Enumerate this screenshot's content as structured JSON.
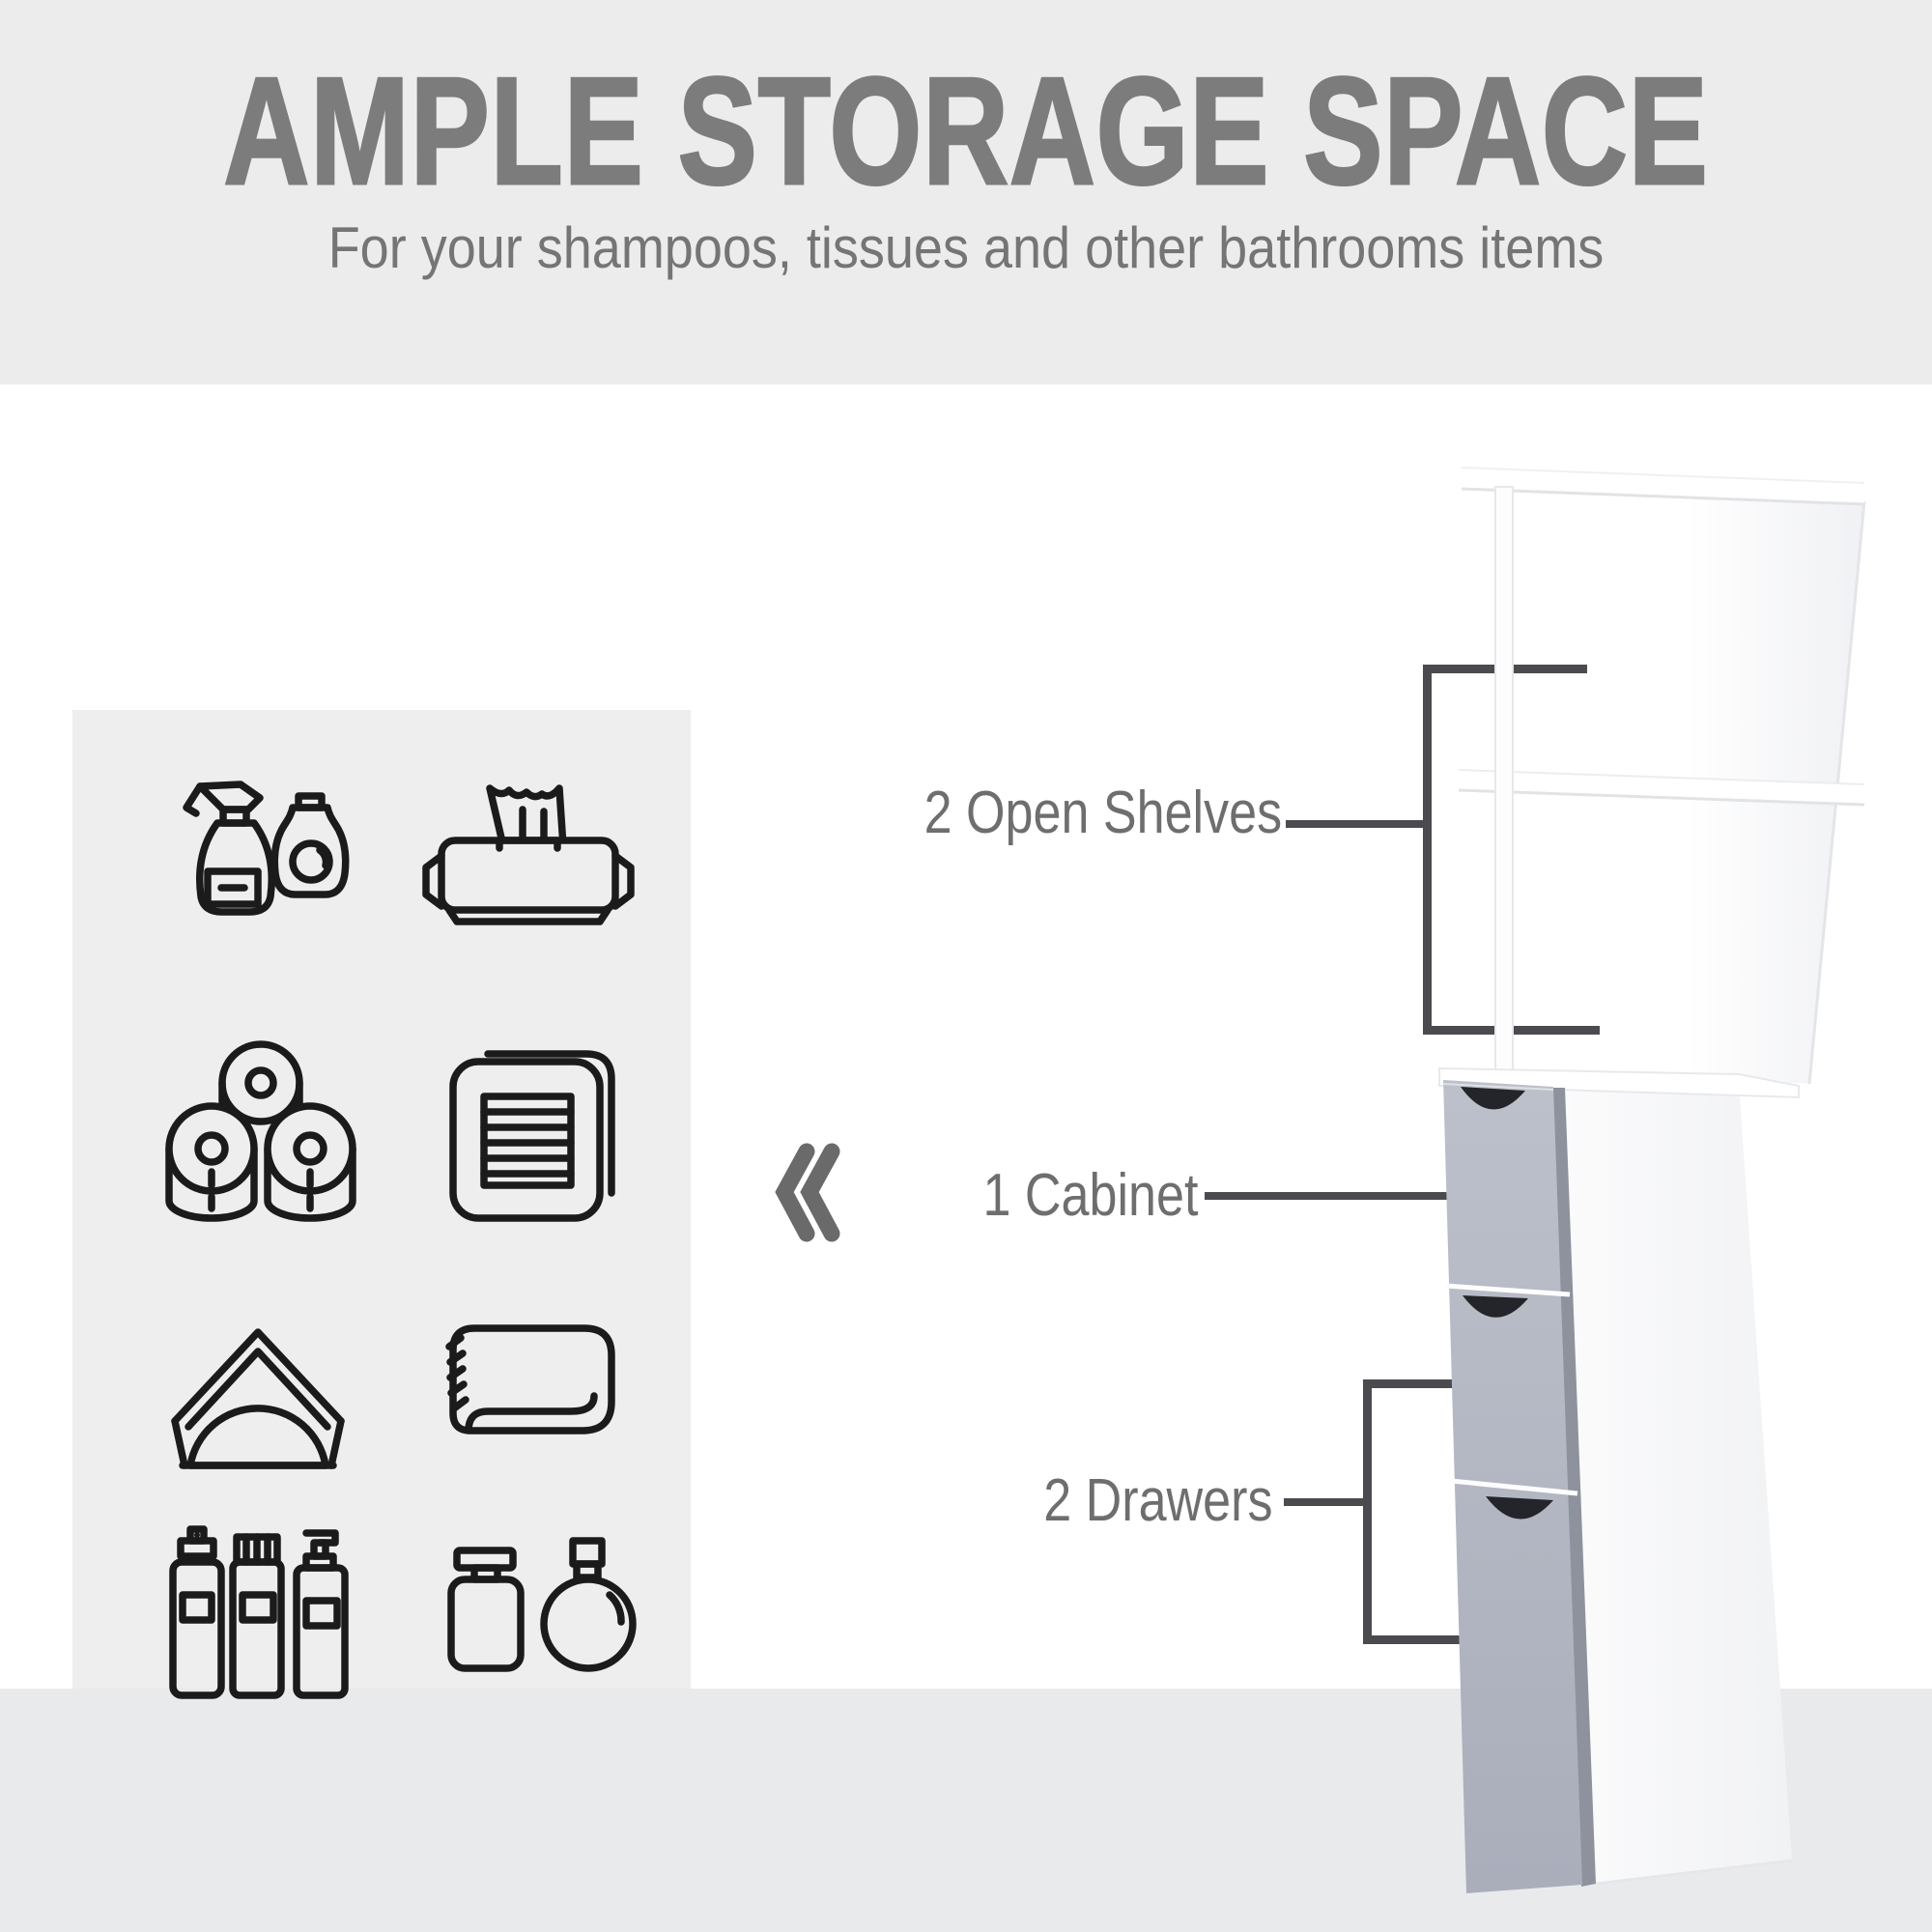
{
  "header": {
    "title": "AMPLE STORAGE SPACE",
    "subtitle": "For your shampoos, tissues and other bathrooms items"
  },
  "chevron_glyph": "«",
  "callouts": {
    "shelves": "2 Open Shelves",
    "cabinet": "1 Cabinet",
    "drawers": "2 Drawers"
  },
  "icons": {
    "items": [
      "spray-bottle-and-detergent",
      "wet-wipes-pack",
      "toilet-paper-rolls",
      "paper-towel-dispenser",
      "napkin-holder",
      "folded-towel",
      "toiletry-bottles",
      "perfume-bottles"
    ]
  },
  "colors": {
    "header_band": "#ececec",
    "bottom_band": "#e9eaeb",
    "icon_box": "#eeeeef",
    "title_text": "#7c7c7c",
    "subtitle_text": "#757575",
    "label_text": "#6e6e6e",
    "callout_line": "#4b4b4f",
    "cabinet_front_gray": "#b5b9c4",
    "cabinet_edge_dark": "#8e929d",
    "notch_dark": "#23252a",
    "icon_stroke": "#1b1b1b"
  }
}
